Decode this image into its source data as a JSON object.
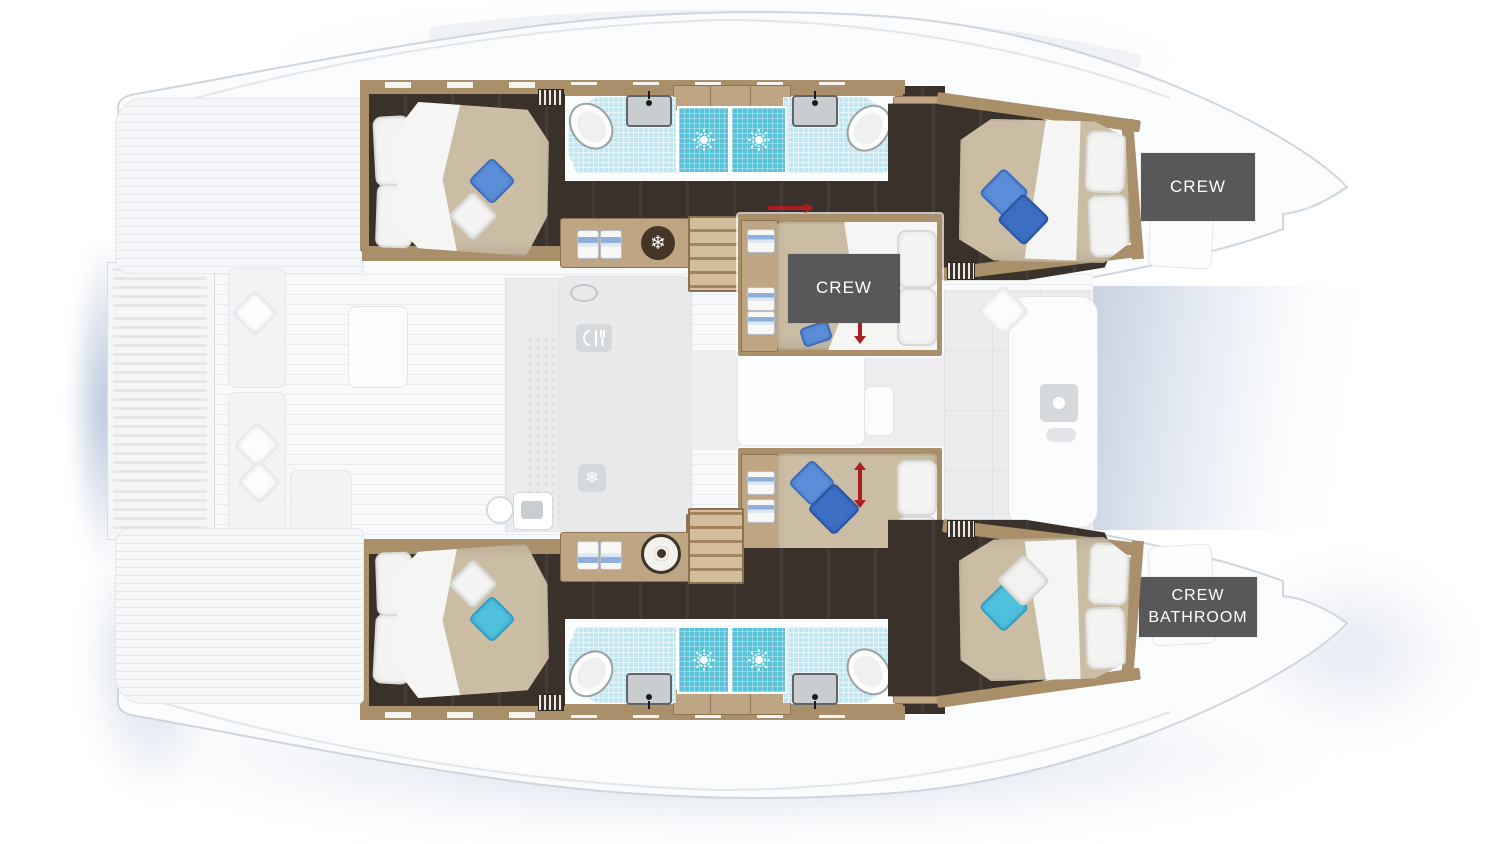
{
  "page": {
    "title": "Catamaran yacht deck plan",
    "description": "Top-view floor plan of a catamaran lower deck: four guest cabins with double beds, four bathrooms with showers, central crew cabins, galley fittings and crew areas in the bows"
  },
  "labels": {
    "crew_fore": "CREW",
    "crew_mid": "CREW",
    "crew_bathroom_line1": "CREW",
    "crew_bathroom_line2": "BATHROOM"
  },
  "icons": {
    "snowflake": "❄",
    "names": [
      "snowflake-icon",
      "washing-machine-icon",
      "shower-jet-icon",
      "sink-icon",
      "toilet-icon",
      "galley-utensils-icon",
      "faucet-icon",
      "vent-grate-icon",
      "towel-icon",
      "stairs",
      "bed-slide-arrow",
      "door-arrow"
    ]
  },
  "palette": {
    "label_bg": "#58585b",
    "label_text": "#ffffff",
    "floor_dark": "#3a312b",
    "wood": "#a98f6a",
    "wood_light": "#bea684",
    "duvet_tan": "#cbbda4",
    "tile_light": "#c3e7f0",
    "tile_shower": "#57c2d8",
    "pillow_blue_a": "#5b8ed9",
    "pillow_blue_b": "#3c6fc4",
    "pillow_cyan": "#4fc0de",
    "arrow_red": "#ab1e22",
    "shadow_blue": "#97aac8"
  }
}
